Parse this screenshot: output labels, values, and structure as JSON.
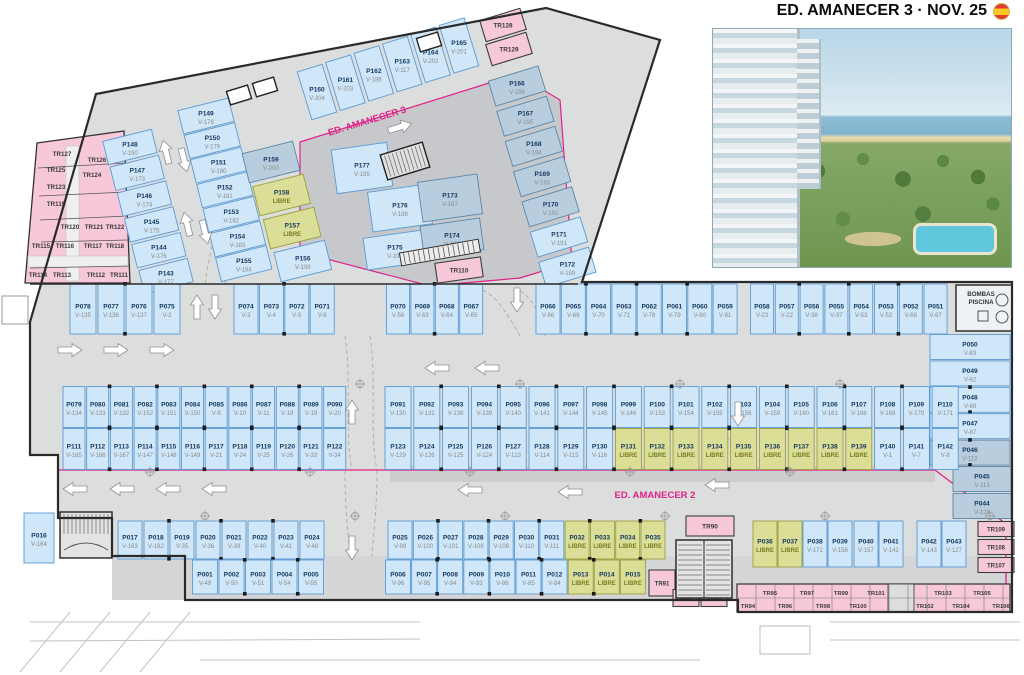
{
  "header": {
    "title": "ED. AMANECER 3 · NOV. 25"
  },
  "zones": {
    "amanecer3": "ED. AMANECER 3",
    "amanecer2": "ED. AMANECER 2"
  },
  "rooms": {
    "bombas_line1": "BOMBAS",
    "bombas_line2": "PISCINA"
  },
  "libre_label": "LIBRE",
  "colors": {
    "stall_fill": "#cfe7f8",
    "stall_border": "#5b9bd5",
    "stall_shaded_fill": "#b8cede",
    "stall_shaded_border": "#5d86a8",
    "libre_fill": "#dbde97",
    "libre_border": "#9aa13f",
    "libre_text": "#787d22",
    "trastero_fill": "#f6c8d9",
    "trastero_border": "#3d3d3d",
    "road": "#dcdddd",
    "zone_line": "#e0218a",
    "id_text": "#14375f",
    "v_text": "#8a8a8a"
  },
  "parking_groups": {
    "a3_col_a": [
      [
        "P148",
        "V-190"
      ],
      [
        "P147",
        "V-173"
      ],
      [
        "P146",
        "V-174"
      ],
      [
        "P145",
        "V-175"
      ],
      [
        "P144",
        "V-176"
      ],
      [
        "P143",
        "V-177"
      ]
    ],
    "a3_col_b": [
      [
        "P149",
        "V-178"
      ],
      [
        "P150",
        "V-179"
      ],
      [
        "P151",
        "V-180"
      ],
      [
        "P152",
        "V-181"
      ],
      [
        "P153",
        "V-182"
      ],
      [
        "P154",
        "V-183"
      ],
      [
        "P155",
        "V-184"
      ]
    ],
    "a3_top_row": [
      [
        "P160",
        "V-204"
      ],
      [
        "P161",
        "V-203"
      ],
      [
        "P162",
        "V-186"
      ],
      [
        "P163",
        "V-117"
      ],
      [
        "P164",
        "V-202"
      ],
      [
        "P165",
        "V-201"
      ]
    ],
    "a3_right_col": [
      [
        "P166",
        "V-196",
        "S"
      ],
      [
        "P167",
        "V-195",
        "S"
      ],
      [
        "P168",
        "V-194",
        "S"
      ],
      [
        "P169",
        "V-193",
        "S"
      ],
      [
        "P170",
        "V-192",
        "S"
      ],
      [
        "P171",
        "V-191"
      ],
      [
        "P172",
        "V-189"
      ]
    ],
    "a3_green_col": [
      [
        "P159",
        "V-200",
        "S"
      ],
      [
        "P158",
        "",
        "L"
      ],
      [
        "P157",
        "",
        "L"
      ],
      [
        "P156",
        "V-199"
      ]
    ],
    "a3_cluster": [
      [
        "P177",
        "V-185"
      ],
      [
        "P176",
        "V-198"
      ],
      [
        "P175",
        "V-197"
      ],
      [
        "P173",
        "V-187",
        "S"
      ],
      [
        "P174",
        "V-188",
        "S"
      ]
    ],
    "row1_l1": [
      [
        "P078",
        "V-135"
      ],
      [
        "P077",
        "V-136"
      ],
      [
        "P076",
        "V-137"
      ],
      [
        "P075",
        "V-2"
      ]
    ],
    "row1_l2": [
      [
        "P074",
        "V-3"
      ],
      [
        "P073",
        "V-4"
      ],
      [
        "P072",
        "V-5"
      ],
      [
        "P071",
        "V-6"
      ]
    ],
    "row1_m1": [
      [
        "P070",
        "V-56"
      ],
      [
        "P069",
        "V-63"
      ],
      [
        "P068",
        "V-64"
      ],
      [
        "P067",
        "V-65"
      ]
    ],
    "row1_m2": [
      [
        "P066",
        "V-66"
      ],
      [
        "P065",
        "V-69"
      ],
      [
        "P064",
        "V-70"
      ],
      [
        "P063",
        "V-71"
      ],
      [
        "P062",
        "V-78"
      ],
      [
        "P061",
        "V-79"
      ],
      [
        "P060",
        "V-80"
      ],
      [
        "P059",
        "V-81"
      ]
    ],
    "row1_r": [
      [
        "P058",
        "V-23"
      ],
      [
        "P057",
        "V-22"
      ],
      [
        "P056",
        "V-38"
      ],
      [
        "P055",
        "V-37"
      ],
      [
        "P054",
        "V-53"
      ],
      [
        "P053",
        "V-52"
      ],
      [
        "P052",
        "V-68"
      ],
      [
        "P051",
        "V-67"
      ]
    ],
    "right_col": [
      [
        "P050",
        "V-83"
      ],
      [
        "P049",
        "V-82"
      ],
      [
        "P048",
        "V-88"
      ],
      [
        "P047",
        "V-87"
      ],
      [
        "P046",
        "V-112",
        "S"
      ]
    ],
    "right_col2": [
      [
        "P045",
        "V-113",
        "S"
      ],
      [
        "P044",
        "V-128",
        "S"
      ]
    ],
    "band_tl": [
      [
        "P079",
        "V-134"
      ],
      [
        "P080",
        "V-133"
      ],
      [
        "P081",
        "V-132"
      ],
      [
        "P082",
        "V-152"
      ],
      [
        "P083",
        "V-151"
      ],
      [
        "P084",
        "V-150"
      ],
      [
        "P085",
        "V-9"
      ],
      [
        "P086",
        "V-10"
      ],
      [
        "P087",
        "V-11"
      ],
      [
        "P088",
        "V-18"
      ],
      [
        "P089",
        "V-19"
      ],
      [
        "P090",
        "V-20"
      ]
    ],
    "band_bl": [
      [
        "P111",
        "V-165"
      ],
      [
        "P112",
        "V-166"
      ],
      [
        "P113",
        "V-167"
      ],
      [
        "P114",
        "V-147"
      ],
      [
        "P115",
        "V-148"
      ],
      [
        "P116",
        "V-149"
      ],
      [
        "P117",
        "V-21"
      ],
      [
        "P118",
        "V-24"
      ],
      [
        "P119",
        "V-25"
      ],
      [
        "P120",
        "V-26"
      ],
      [
        "P121",
        "V-33"
      ],
      [
        "P122",
        "V-34"
      ]
    ],
    "band_tr": [
      [
        "P091",
        "V-130"
      ],
      [
        "P092",
        "V-131"
      ],
      [
        "P093",
        "V-138"
      ],
      [
        "P094",
        "V-139"
      ],
      [
        "P095",
        "V-140"
      ],
      [
        "P096",
        "V-141"
      ],
      [
        "P097",
        "V-144"
      ],
      [
        "P098",
        "V-145"
      ],
      [
        "P099",
        "V-146"
      ],
      [
        "P100",
        "V-153"
      ],
      [
        "P101",
        "V-154"
      ],
      [
        "P102",
        "V-155"
      ],
      [
        "P103",
        "V-156"
      ],
      [
        "P104",
        "V-159"
      ],
      [
        "P105",
        "V-160"
      ],
      [
        "P106",
        "V-161"
      ],
      [
        "P107",
        "V-168"
      ],
      [
        "P108",
        "V-169"
      ],
      [
        "P109",
        "V-170"
      ],
      [
        "P110",
        "V-171"
      ]
    ],
    "band_br": [
      [
        "P123",
        "V-129"
      ],
      [
        "P124",
        "V-126"
      ],
      [
        "P125",
        "V-125"
      ],
      [
        "P126",
        "V-124"
      ],
      [
        "P127",
        "V-123"
      ],
      [
        "P128",
        "V-114"
      ],
      [
        "P129",
        "V-115"
      ],
      [
        "P130",
        "V-116"
      ],
      [
        "P131",
        "",
        "L"
      ],
      [
        "P132",
        "",
        "L"
      ],
      [
        "P133",
        "",
        "L"
      ],
      [
        "P134",
        "",
        "L"
      ],
      [
        "P135",
        "",
        "L"
      ],
      [
        "P136",
        "",
        "L"
      ],
      [
        "P137",
        "",
        "L"
      ],
      [
        "P138",
        "",
        "L"
      ],
      [
        "P139",
        "",
        "L"
      ],
      [
        "P140",
        "V-1"
      ],
      [
        "P141",
        "V-7"
      ],
      [
        "P142",
        "V-8"
      ]
    ],
    "p016": [
      [
        "P016",
        "V-164"
      ]
    ],
    "bot_tl": [
      [
        "P017",
        "V-163"
      ],
      [
        "P018",
        "V-162"
      ],
      [
        "P019",
        "V-35"
      ],
      [
        "P020",
        "V-36"
      ],
      [
        "P021",
        "V-39"
      ],
      [
        "P022",
        "V-40"
      ],
      [
        "P023",
        "V-41"
      ],
      [
        "P024",
        "V-48"
      ]
    ],
    "bot_bl": [
      [
        "P001",
        "V-49"
      ],
      [
        "P002",
        "V-50"
      ],
      [
        "P003",
        "V-51"
      ],
      [
        "P004",
        "V-54"
      ],
      [
        "P005",
        "V-55"
      ]
    ],
    "bot_tm": [
      [
        "P025",
        "V-99"
      ],
      [
        "P026",
        "V-100"
      ],
      [
        "P027",
        "V-101"
      ],
      [
        "P028",
        "V-108"
      ],
      [
        "P029",
        "V-109"
      ],
      [
        "P030",
        "V-110"
      ],
      [
        "P031",
        "V-111"
      ],
      [
        "P032",
        "",
        "L"
      ],
      [
        "P033",
        "",
        "L"
      ],
      [
        "P034",
        "",
        "L"
      ],
      [
        "P035",
        "",
        "L"
      ]
    ],
    "bot_bm": [
      [
        "P006",
        "V-96"
      ],
      [
        "P007",
        "V-95"
      ],
      [
        "P008",
        "V-94"
      ],
      [
        "P009",
        "V-93"
      ],
      [
        "P010",
        "V-86"
      ],
      [
        "P011",
        "V-85"
      ],
      [
        "P012",
        "V-84"
      ],
      [
        "P013",
        "",
        "L"
      ],
      [
        "P014",
        "",
        "L"
      ],
      [
        "P015",
        "",
        "L"
      ]
    ],
    "bot_tr": [
      [
        "P036",
        "",
        "L"
      ],
      [
        "P037",
        "",
        "L"
      ],
      [
        "P038",
        "V-172"
      ],
      [
        "P039",
        "V-158"
      ],
      [
        "P040",
        "V-157"
      ],
      [
        "P041",
        "V-142"
      ],
      [
        "P042",
        "V-143"
      ],
      [
        "P043",
        "V-127"
      ]
    ]
  },
  "trasteros": {
    "left_block": [
      "TR127",
      "TR126",
      "TR125",
      "TR124",
      "TR123",
      "TR119",
      "TR120",
      "TR121",
      "TR122",
      "TR115",
      "TR116",
      "TR117",
      "TR118",
      "TR114",
      "TR113",
      "TR112",
      "TR111"
    ],
    "top_pair": [
      "TR128",
      "TR129"
    ],
    "mid": [
      "TR110"
    ],
    "right_col": [
      "TR109",
      "TR108",
      "TR107"
    ],
    "bottom_rooms": [
      "TR90",
      "TR91",
      "TR92",
      "TR93"
    ],
    "strip_upper": [
      "TR95",
      "TR97",
      "TR99",
      "TR101",
      "TR103",
      "TR105"
    ],
    "strip_lower": [
      "TR94",
      "TR96",
      "TR98",
      "TR100",
      "TR102",
      "TR104",
      "TR106"
    ]
  }
}
